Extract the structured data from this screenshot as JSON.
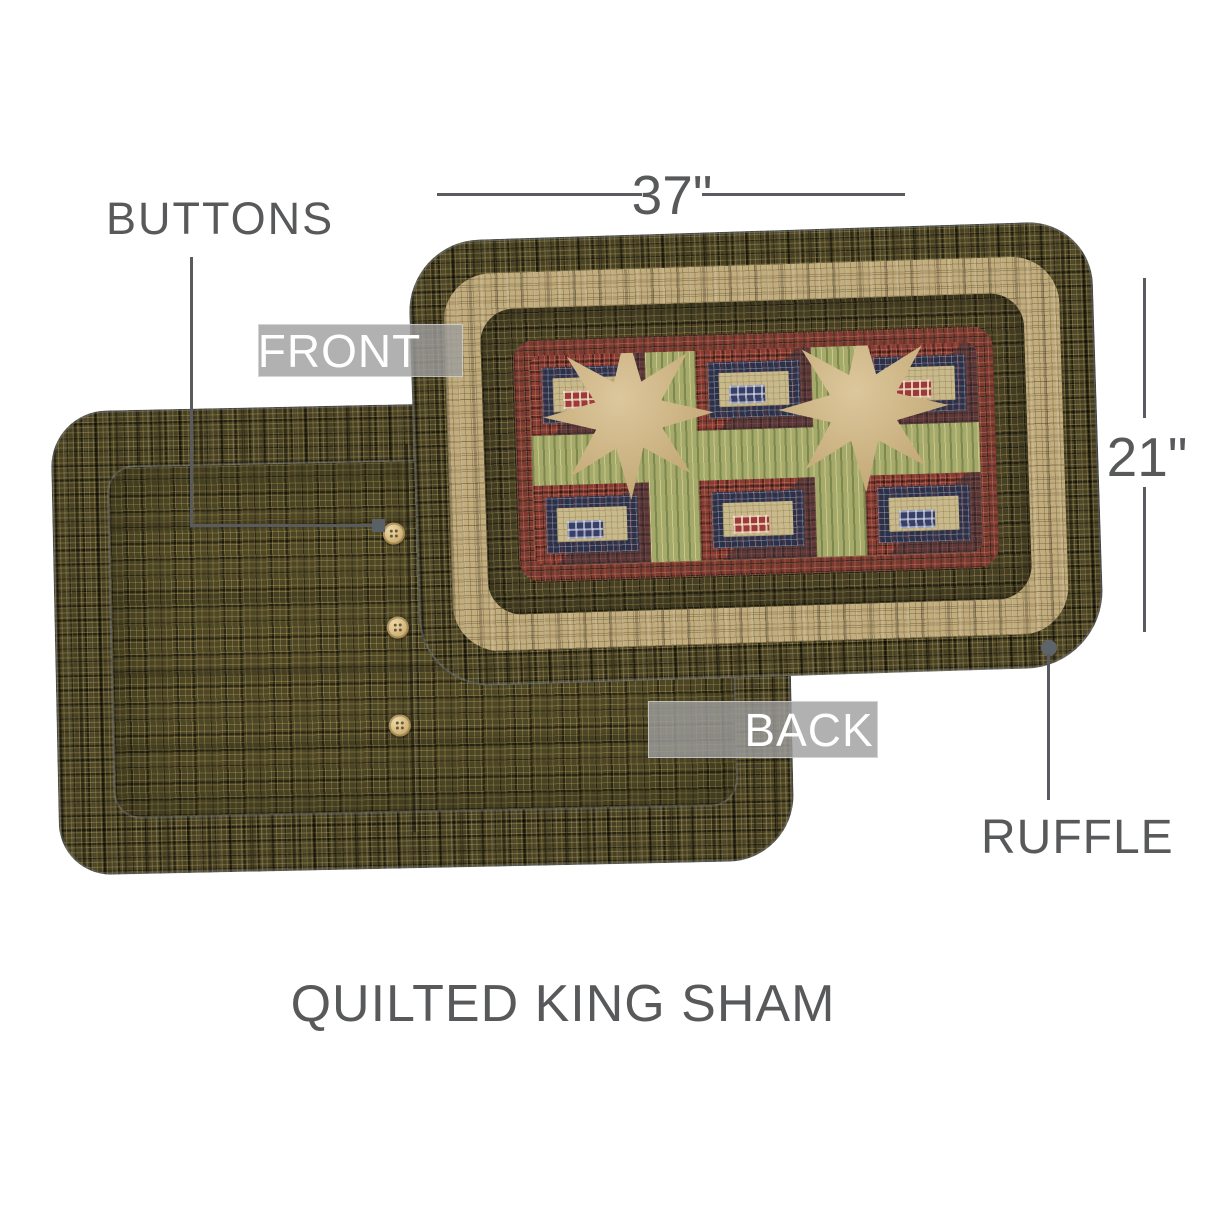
{
  "title": "QUILTED KING SHAM",
  "labels": {
    "buttons": "BUTTONS",
    "front": "FRONT",
    "back": "BACK",
    "ruffle": "RUFFLE"
  },
  "dimensions": {
    "width": "37\"",
    "height": "21\""
  },
  "back_pillow": {
    "button_count": 3
  },
  "colors": {
    "annotation_text": "#58595b",
    "callout_line": "#5a5b5e",
    "label_background": "rgba(158,158,158,0.8)",
    "label_text": "#ffffff",
    "olive_plaid": "#474023",
    "tan_band": "#c2ad7e",
    "red_plaid": "#7e3830",
    "navy_plaid": "#2c3147",
    "green_sashing": "#a5aa6b",
    "tan_star": "#d3bb8e",
    "button": "#d2b67b"
  }
}
